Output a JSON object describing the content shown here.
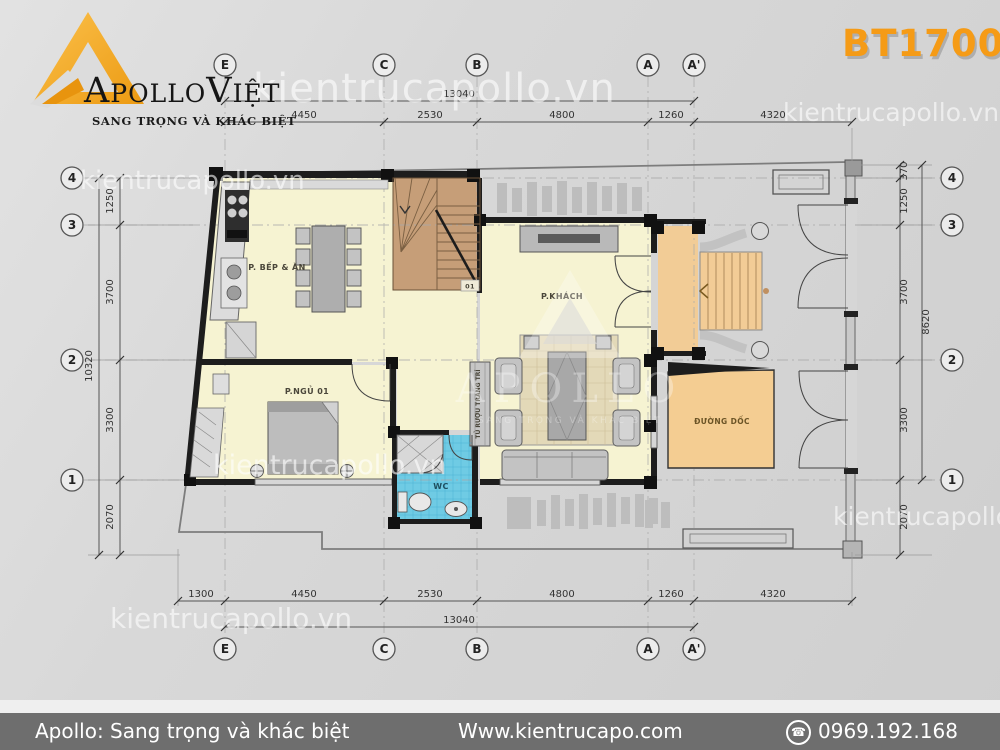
{
  "header": {
    "brand": {
      "part1": "Apollo",
      "part2": "Việt",
      "tagline": "SANG TRỌNG VÀ KHÁC BIỆT"
    },
    "project_code": "BT17006"
  },
  "watermark": {
    "url": "kientrucapollo.vn",
    "url_clipped": "kientrucapollo.v",
    "brand": "APOLLO",
    "brand_sub": "SANG TRỌNG VÀ KHÁC BIỆT"
  },
  "plan": {
    "room_labels": {
      "kitchen": "P. BẾP & ĂN",
      "living": "P.KHÁCH",
      "bedroom": "P.NGỦ 01",
      "wc": "WC",
      "ramp": "ĐƯỜNG DỐC",
      "wine_cabinet": "TỦ RƯỢU TRANG TRÍ",
      "stair_note": "01"
    },
    "grid_cols": [
      "E",
      "C",
      "B",
      "A",
      "A'"
    ],
    "grid_rows": [
      "4",
      "3",
      "2",
      "1"
    ],
    "dims": {
      "top": [
        "4450",
        "2530",
        "4800",
        "1260",
        "4320"
      ],
      "top_total": "13040",
      "bottom": [
        "1300",
        "4450",
        "2530",
        "4800",
        "1260",
        "4320"
      ],
      "bottom_total": "13040",
      "left": [
        "1250",
        "3700",
        "3300",
        "2070"
      ],
      "left_total": "10320",
      "right": [
        "370",
        "1250",
        "3700",
        "3300",
        "2070"
      ],
      "right_total": "8620"
    }
  },
  "footer": {
    "tagline": "Apollo: Sang trọng và khác biệt",
    "website": "Www.kientrucapo.com",
    "phone": "0969.192.168"
  },
  "colors": {
    "accent_orange": "#f59b16",
    "room_yellow": "#f6f3d2",
    "stair_brown": "#c69e78",
    "porch_tan": "#f2cc96",
    "wc_blue": "#6fcbe4",
    "footer_gray": "#6e6e6e"
  }
}
